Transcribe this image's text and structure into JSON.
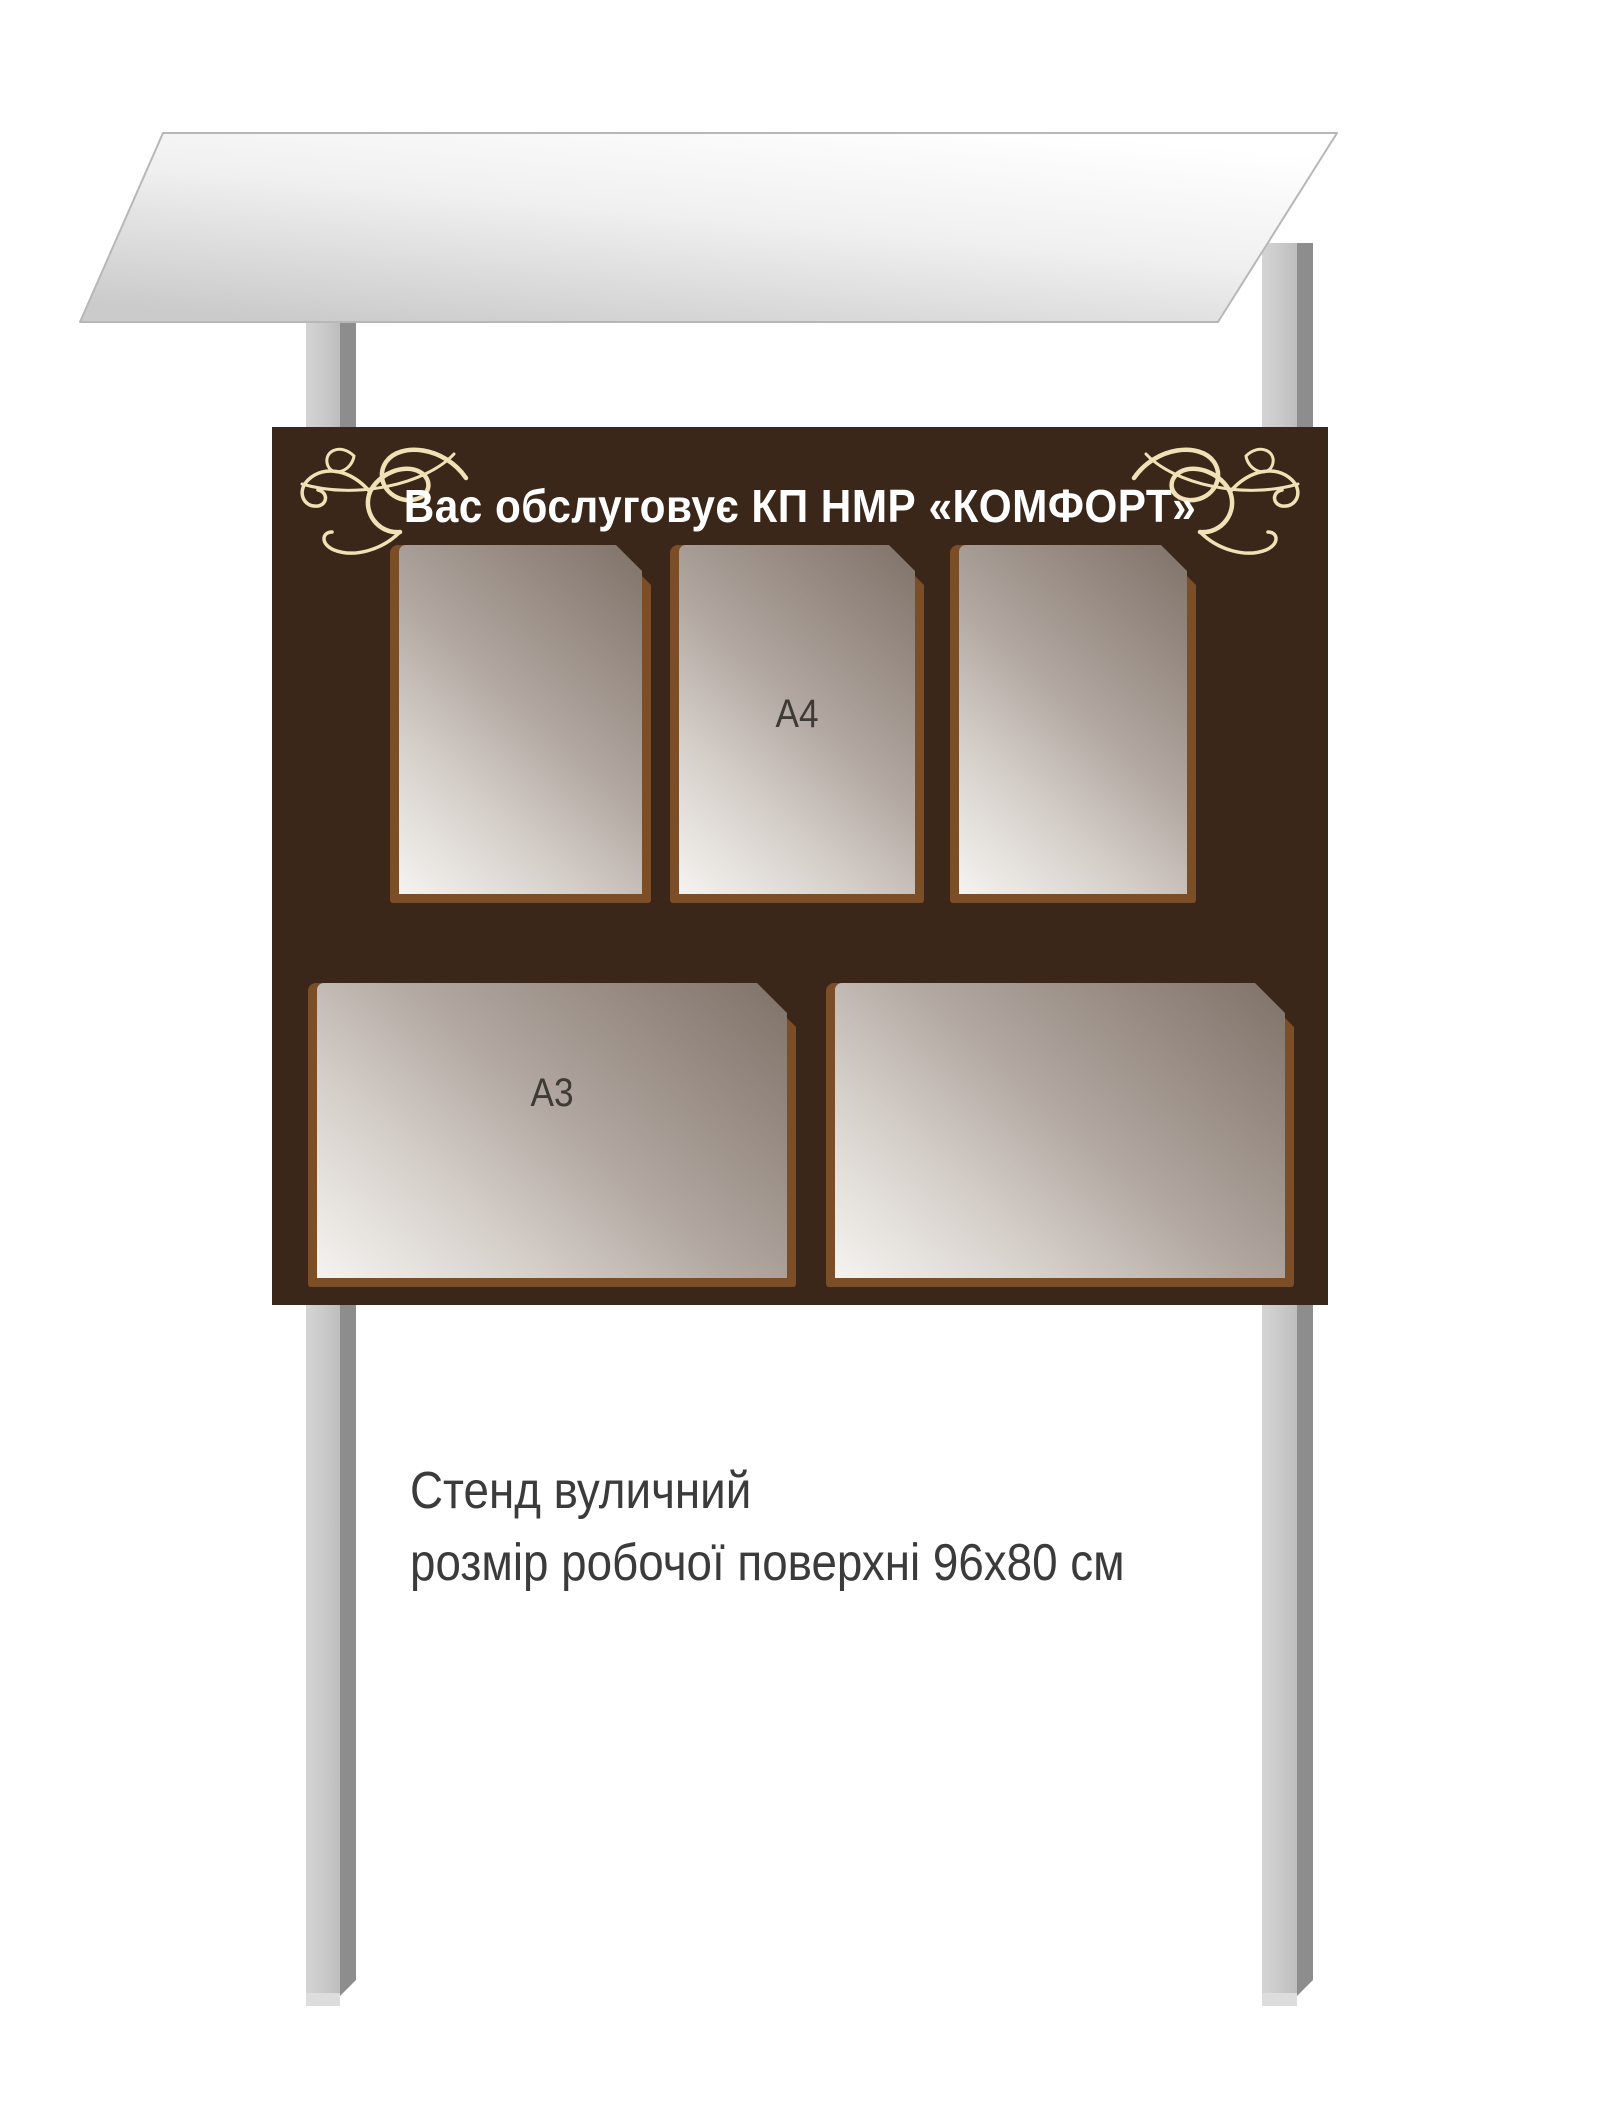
{
  "title": "Вас обслуговує КП НМР «КОМФОРТ»",
  "pockets": {
    "a4_label": "А4",
    "a3_label": "А3"
  },
  "caption": {
    "line1": "Стенд вуличний",
    "line2": "розмір робочої поверхні 96х80 см"
  },
  "colors": {
    "board": "#3a2719",
    "frame": "#7c4e27",
    "ornament": "#f0e2b6",
    "title_text": "#ffffff",
    "label_text": "#3e3a35",
    "caption_text": "#3b3b3b",
    "post_light": "#c7c7c7",
    "post_dark": "#8d8d8d",
    "roof_light": "#ffffff",
    "roof_dark": "#cbcbcb",
    "roof_edge": "#b7b7b7"
  }
}
